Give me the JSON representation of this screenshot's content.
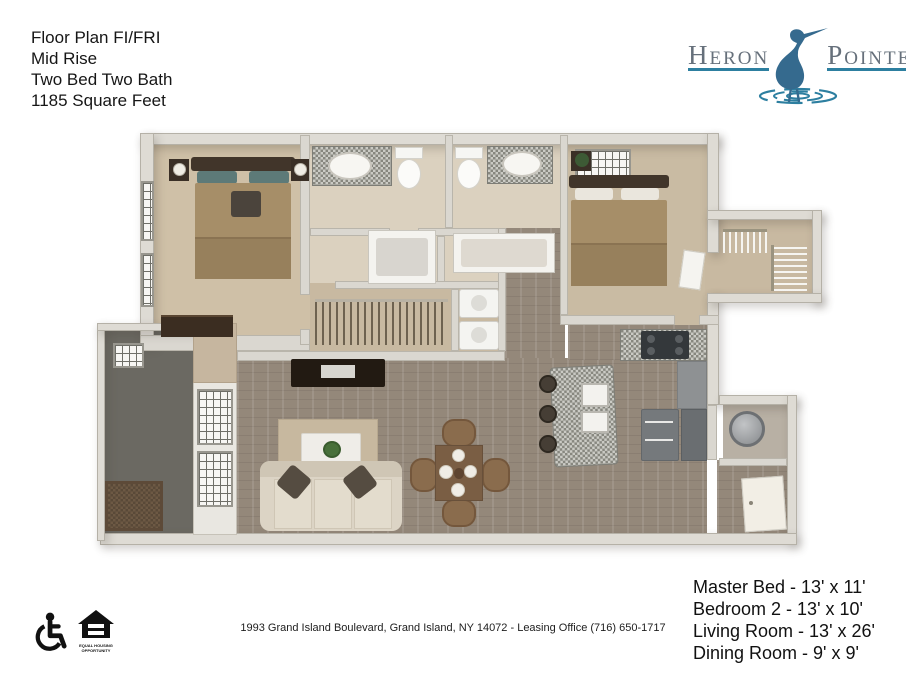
{
  "header": {
    "plan_title_lines": [
      "Floor Plan FI/FRI",
      "Mid Rise",
      "Two Bed Two Bath",
      "1185 Square Feet"
    ]
  },
  "logo": {
    "word_left": "Heron",
    "word_right": "Pointe",
    "text_color": "#66707b",
    "accent_color": "#2d7fa0",
    "bird_color": "#356a8e"
  },
  "floor_plan": {
    "rooms": [
      "master-bedroom",
      "master-bathroom",
      "walk-in-closet",
      "laundry",
      "bathroom-2",
      "bedroom-2",
      "bedroom-2-closet",
      "hallway",
      "living-room",
      "dining-area",
      "kitchen",
      "utility-room",
      "entry",
      "balcony"
    ]
  },
  "footer": {
    "accessibility": {
      "equal_housing_line1": "EQUAL HOUSING",
      "equal_housing_line2": "OPPORTUNITY"
    },
    "address": "1993 Grand Island Boulevard, Grand Island, NY 14072 - Leasing Office (716) 650-1717",
    "room_dimensions": [
      "Master Bed - 13' x 11'",
      "Bedroom 2 -  13' x 10'",
      "Living Room - 13' x 26'",
      "Dining Room - 9' x 9'"
    ]
  }
}
